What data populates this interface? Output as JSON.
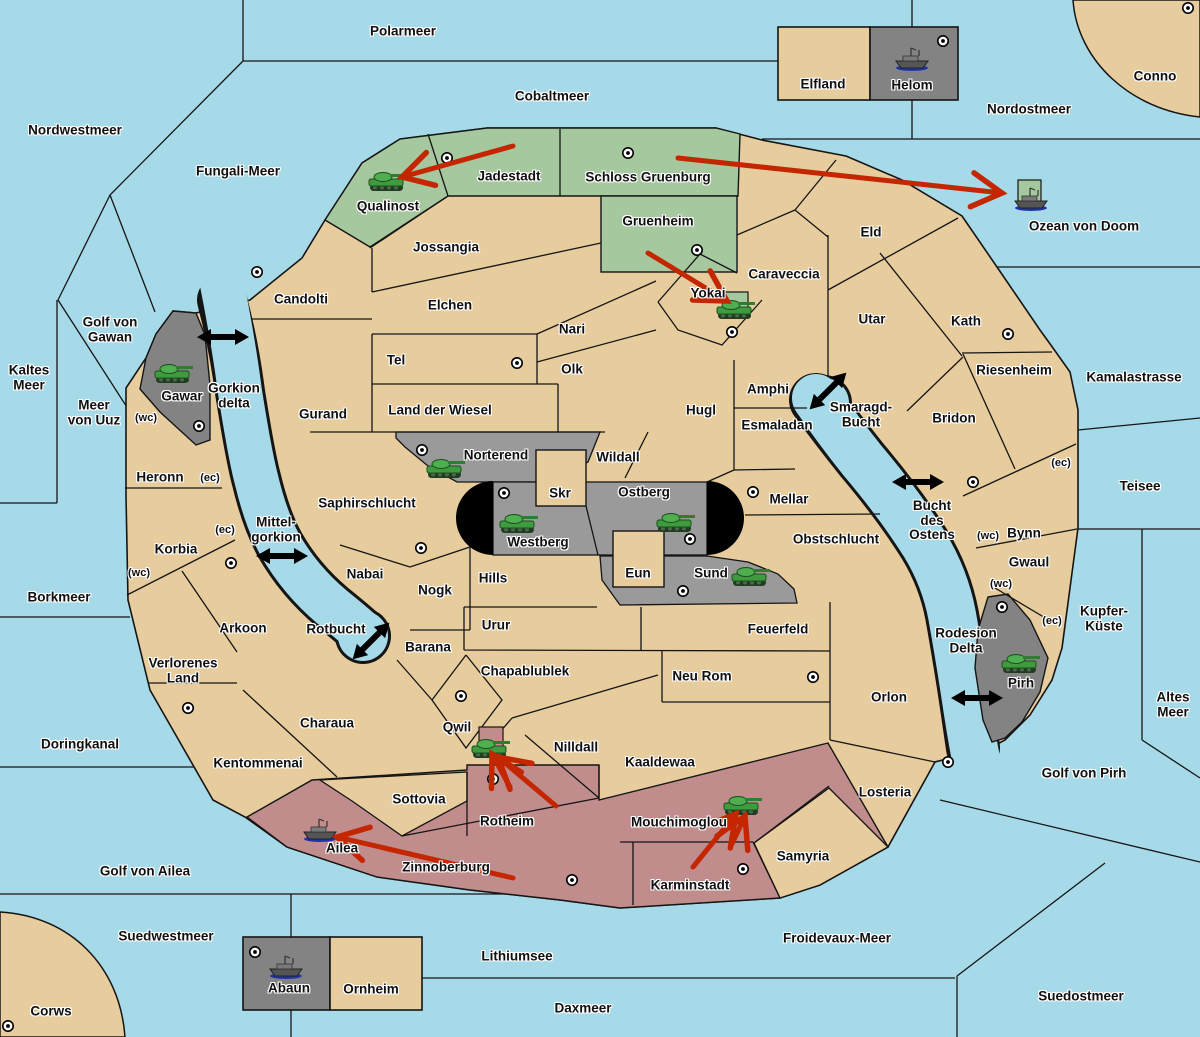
{
  "map_title": "Wargame strategy map",
  "canvas": {
    "width": 1200,
    "height": 1037
  },
  "colors": {
    "sea": "#A7DAE8",
    "land": "#E7CC9E",
    "green": "#A6C89F",
    "red": "#C18C8C",
    "gray_light": "#9A9A9A",
    "gray_dark": "#838383",
    "black": "#000000",
    "arrow": "#C42600",
    "border": "#151515"
  },
  "labels": {
    "sea": [
      {
        "t": "Polarmeer",
        "x": 403,
        "y": 32
      },
      {
        "t": "Cobaltmeer",
        "x": 552,
        "y": 97
      },
      {
        "t": "Nordwestmeer",
        "x": 75,
        "y": 131
      },
      {
        "t": "Fungali-Meer",
        "x": 238,
        "y": 172
      },
      {
        "t": "Nordostmeer",
        "x": 1029,
        "y": 110
      },
      {
        "t": "Ozean von Doom",
        "x": 1084,
        "y": 227
      },
      {
        "t": "Kaltes\nMeer",
        "x": 29,
        "y": 378
      },
      {
        "t": "Golf von\nGawan",
        "x": 110,
        "y": 330
      },
      {
        "t": "Meer\nvon Uuz",
        "x": 94,
        "y": 413
      },
      {
        "t": "Gorkion\ndelta",
        "x": 234,
        "y": 396
      },
      {
        "t": "Kamalastrasse",
        "x": 1134,
        "y": 378
      },
      {
        "t": "Teisee",
        "x": 1140,
        "y": 487
      },
      {
        "t": "Smaragd-\nBucht",
        "x": 861,
        "y": 415
      },
      {
        "t": "Mittel-\ngorkion",
        "x": 276,
        "y": 530
      },
      {
        "t": "Bucht\ndes\nOstens",
        "x": 932,
        "y": 521
      },
      {
        "t": "Borkmeer",
        "x": 59,
        "y": 598
      },
      {
        "t": "Kupfer-\nKüste",
        "x": 1104,
        "y": 619
      },
      {
        "t": "Rotbucht",
        "x": 336,
        "y": 630
      },
      {
        "t": "Altes\nMeer",
        "x": 1173,
        "y": 705
      },
      {
        "t": "Rodesion\nDelta",
        "x": 966,
        "y": 641
      },
      {
        "t": "Doringkanal",
        "x": 80,
        "y": 745
      },
      {
        "t": "Golf von Pirh",
        "x": 1084,
        "y": 774
      },
      {
        "t": "Golf von Ailea",
        "x": 145,
        "y": 872
      },
      {
        "t": "Suedwestmeer",
        "x": 166,
        "y": 937
      },
      {
        "t": "Froidevaux-Meer",
        "x": 837,
        "y": 939
      },
      {
        "t": "Lithiumsee",
        "x": 517,
        "y": 957
      },
      {
        "t": "Daxmeer",
        "x": 583,
        "y": 1009
      },
      {
        "t": "Suedostmeer",
        "x": 1081,
        "y": 997
      }
    ],
    "land": [
      {
        "t": "Qualinost",
        "x": 388,
        "y": 207
      },
      {
        "t": "Jadestadt",
        "x": 509,
        "y": 177
      },
      {
        "t": "Schloss Gruenburg",
        "x": 648,
        "y": 178
      },
      {
        "t": "Gruenheim",
        "x": 658,
        "y": 222
      },
      {
        "t": "Jossangia",
        "x": 446,
        "y": 248
      },
      {
        "t": "Candolti",
        "x": 301,
        "y": 300
      },
      {
        "t": "Elchen",
        "x": 450,
        "y": 306
      },
      {
        "t": "Nari",
        "x": 572,
        "y": 330
      },
      {
        "t": "Olk",
        "x": 572,
        "y": 370
      },
      {
        "t": "Tel",
        "x": 396,
        "y": 361
      },
      {
        "t": "Gurand",
        "x": 323,
        "y": 415
      },
      {
        "t": "Land der Wiesel",
        "x": 440,
        "y": 411
      },
      {
        "t": "Yokai",
        "x": 708,
        "y": 294
      },
      {
        "t": "Caraveccia",
        "x": 784,
        "y": 275
      },
      {
        "t": "Eld",
        "x": 871,
        "y": 233
      },
      {
        "t": "Utar",
        "x": 872,
        "y": 320
      },
      {
        "t": "Kath",
        "x": 966,
        "y": 322
      },
      {
        "t": "Riesenheim",
        "x": 1014,
        "y": 371
      },
      {
        "t": "Bridon",
        "x": 954,
        "y": 419
      },
      {
        "t": "Amphi",
        "x": 768,
        "y": 390
      },
      {
        "t": "Hugl",
        "x": 701,
        "y": 411
      },
      {
        "t": "Esmaladan",
        "x": 777,
        "y": 426
      },
      {
        "t": "Wildall",
        "x": 618,
        "y": 458
      },
      {
        "t": "Norterend",
        "x": 496,
        "y": 456
      },
      {
        "t": "Skr",
        "x": 560,
        "y": 494
      },
      {
        "t": "Ostberg",
        "x": 644,
        "y": 493
      },
      {
        "t": "Westberg",
        "x": 538,
        "y": 543
      },
      {
        "t": "Mellar",
        "x": 789,
        "y": 500
      },
      {
        "t": "Obstschlucht",
        "x": 836,
        "y": 540
      },
      {
        "t": "Heronn",
        "x": 160,
        "y": 478
      },
      {
        "t": "Gawar",
        "x": 182,
        "y": 397
      },
      {
        "t": "Korbia",
        "x": 176,
        "y": 550
      },
      {
        "t": "Saphirschlucht",
        "x": 367,
        "y": 504
      },
      {
        "t": "Nabai",
        "x": 365,
        "y": 575
      },
      {
        "t": "Nogk",
        "x": 435,
        "y": 591
      },
      {
        "t": "Hills",
        "x": 493,
        "y": 579
      },
      {
        "t": "Eun",
        "x": 638,
        "y": 574
      },
      {
        "t": "Sund",
        "x": 711,
        "y": 574
      },
      {
        "t": "Bynn",
        "x": 1024,
        "y": 534
      },
      {
        "t": "Gwaul",
        "x": 1029,
        "y": 563
      },
      {
        "t": "Urur",
        "x": 496,
        "y": 626
      },
      {
        "t": "Feuerfeld",
        "x": 778,
        "y": 630
      },
      {
        "t": "Arkoon",
        "x": 243,
        "y": 629
      },
      {
        "t": "Barana",
        "x": 428,
        "y": 648
      },
      {
        "t": "Verlorenes\nLand",
        "x": 183,
        "y": 671
      },
      {
        "t": "Chapablublek",
        "x": 525,
        "y": 672
      },
      {
        "t": "Neu Rom",
        "x": 702,
        "y": 677
      },
      {
        "t": "Orlon",
        "x": 889,
        "y": 698
      },
      {
        "t": "Pirh",
        "x": 1021,
        "y": 684
      },
      {
        "t": "Charaua",
        "x": 327,
        "y": 724
      },
      {
        "t": "Qwil",
        "x": 457,
        "y": 728
      },
      {
        "t": "Nilldall",
        "x": 576,
        "y": 748
      },
      {
        "t": "Kaaldewaa",
        "x": 660,
        "y": 763
      },
      {
        "t": "Kentommenai",
        "x": 258,
        "y": 764
      },
      {
        "t": "Sottovia",
        "x": 419,
        "y": 800
      },
      {
        "t": "Rotheim",
        "x": 507,
        "y": 822
      },
      {
        "t": "Mouchimoglou",
        "x": 679,
        "y": 823
      },
      {
        "t": "Losteria",
        "x": 885,
        "y": 793
      },
      {
        "t": "Ailea",
        "x": 342,
        "y": 849
      },
      {
        "t": "Zinnoberburg",
        "x": 446,
        "y": 868
      },
      {
        "t": "Samyria",
        "x": 803,
        "y": 857
      },
      {
        "t": "Karminstadt",
        "x": 690,
        "y": 886
      },
      {
        "t": "Elfland",
        "x": 823,
        "y": 85
      },
      {
        "t": "Helom",
        "x": 912,
        "y": 86
      },
      {
        "t": "Abaun",
        "x": 289,
        "y": 989
      },
      {
        "t": "Ornheim",
        "x": 371,
        "y": 990
      },
      {
        "t": "Conno",
        "x": 1155,
        "y": 77
      },
      {
        "t": "Corws",
        "x": 51,
        "y": 1012
      }
    ],
    "links": [
      {
        "t": "(wc)",
        "x": 146,
        "y": 419
      },
      {
        "t": "(ec)",
        "x": 210,
        "y": 479
      },
      {
        "t": "(ec)",
        "x": 225,
        "y": 531
      },
      {
        "t": "(wc)",
        "x": 139,
        "y": 574
      },
      {
        "t": "(ec)",
        "x": 1061,
        "y": 464
      },
      {
        "t": "(wc)",
        "x": 988,
        "y": 537
      },
      {
        "t": "(wc)",
        "x": 1001,
        "y": 585
      },
      {
        "t": "(ec)",
        "x": 1052,
        "y": 622
      }
    ]
  },
  "cities": [
    [
      1188,
      8
    ],
    [
      943,
      41
    ],
    [
      447,
      158
    ],
    [
      628,
      153
    ],
    [
      697,
      250
    ],
    [
      257,
      272
    ],
    [
      517,
      363
    ],
    [
      732,
      332
    ],
    [
      1008,
      334
    ],
    [
      199,
      426
    ],
    [
      422,
      450
    ],
    [
      504,
      493
    ],
    [
      690,
      539
    ],
    [
      753,
      492
    ],
    [
      683,
      591
    ],
    [
      421,
      548
    ],
    [
      231,
      563
    ],
    [
      188,
      708
    ],
    [
      461,
      696
    ],
    [
      813,
      677
    ],
    [
      493,
      779
    ],
    [
      572,
      880
    ],
    [
      743,
      869
    ],
    [
      948,
      762
    ],
    [
      973,
      482
    ],
    [
      1002,
      607
    ],
    [
      255,
      952
    ],
    [
      8,
      1026
    ]
  ],
  "units": {
    "tanks": [
      {
        "x": 387,
        "y": 182,
        "region": "Qualinost"
      },
      {
        "x": 735,
        "y": 310,
        "region": "Yokai"
      },
      {
        "x": 173,
        "y": 374,
        "region": "Gawar"
      },
      {
        "x": 445,
        "y": 469,
        "region": "Norterend"
      },
      {
        "x": 518,
        "y": 524,
        "region": "Westberg"
      },
      {
        "x": 675,
        "y": 523,
        "region": "Ostberg"
      },
      {
        "x": 750,
        "y": 577,
        "region": "Sund"
      },
      {
        "x": 1020,
        "y": 664,
        "region": "Pirh"
      },
      {
        "x": 490,
        "y": 749,
        "region": "Qwil"
      },
      {
        "x": 742,
        "y": 806,
        "region": "Mouchimoglou"
      }
    ],
    "ships": [
      {
        "x": 912,
        "y": 59,
        "region": "Helom"
      },
      {
        "x": 1031,
        "y": 199,
        "region": "Ozean von Doom"
      },
      {
        "x": 320,
        "y": 830,
        "region": "Ailea"
      },
      {
        "x": 286,
        "y": 967,
        "region": "Abaun"
      }
    ]
  },
  "origin_squares": [
    {
      "x": 725,
      "y": 292,
      "w": 23,
      "h": 24,
      "color": "green"
    },
    {
      "x": 1018,
      "y": 180,
      "w": 23,
      "h": 23,
      "color": "green"
    },
    {
      "x": 479,
      "y": 727,
      "w": 24,
      "h": 23,
      "color": "red"
    }
  ],
  "attack_arrows": [
    [
      513,
      146,
      402,
      177
    ],
    [
      678,
      158,
      1002,
      193
    ],
    [
      648,
      253,
      727,
      301
    ],
    [
      556,
      806,
      498,
      757
    ],
    [
      510,
      787,
      492,
      754
    ],
    [
      693,
      867,
      736,
      814
    ],
    [
      732,
      844,
      745,
      816
    ],
    [
      513,
      878,
      337,
      837
    ]
  ],
  "strait_arrows": [
    {
      "x": 223,
      "y": 337,
      "r": 0
    },
    {
      "x": 282,
      "y": 556,
      "r": 0
    },
    {
      "x": 371,
      "y": 641,
      "r": -45
    },
    {
      "x": 828,
      "y": 391,
      "r": -45
    },
    {
      "x": 918,
      "y": 482,
      "r": 0
    },
    {
      "x": 977,
      "y": 698,
      "r": 0
    }
  ]
}
